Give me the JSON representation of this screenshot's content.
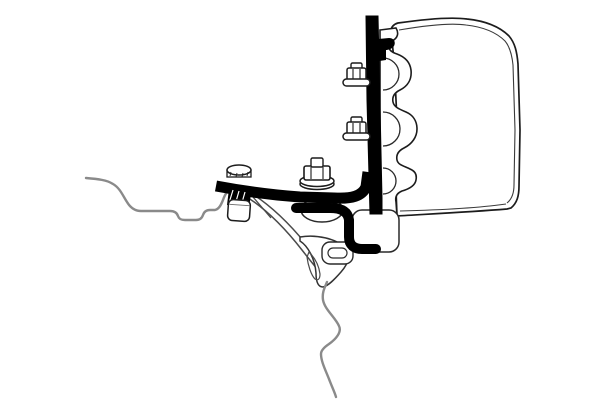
{
  "figure": {
    "kind": "technical-line-illustration",
    "subject": "Awning adapter bracket mounted between vehicle roof profile and awning cassette (cross-section view)",
    "background": "#ffffff"
  },
  "colors": {
    "part_ink": "#000000",
    "outline": "#1c1c1c",
    "detail_line": "#4a4a4a",
    "vehicle_line": "#8a8a8a",
    "fill_white": "#ffffff"
  },
  "parts": {
    "awning_cassette": "awning cassette profile",
    "mounting_rail": "awning mounting rail profile",
    "vertical_bracket": "vertical bracket plate",
    "rail_clip": "rail clip hook",
    "upper_bolt": "upper hex flange bolt",
    "lower_bolt": "lower hex flange bolt",
    "center_bolt": "center hex bolt with washer",
    "adapter_bar": "adapter bar",
    "hook_foot": "adapter hook foot",
    "dome_screw": "dome head clamp screw",
    "clamp_block": "clamp block",
    "spacer": "spacer sleeve",
    "roof_contour": "vehicle roof contour line",
    "body_contour": "vehicle body contour line",
    "flange": "vehicle mounting flange",
    "channel_boss": "rail channel boss",
    "slot_tab": "slotted flange tab"
  }
}
